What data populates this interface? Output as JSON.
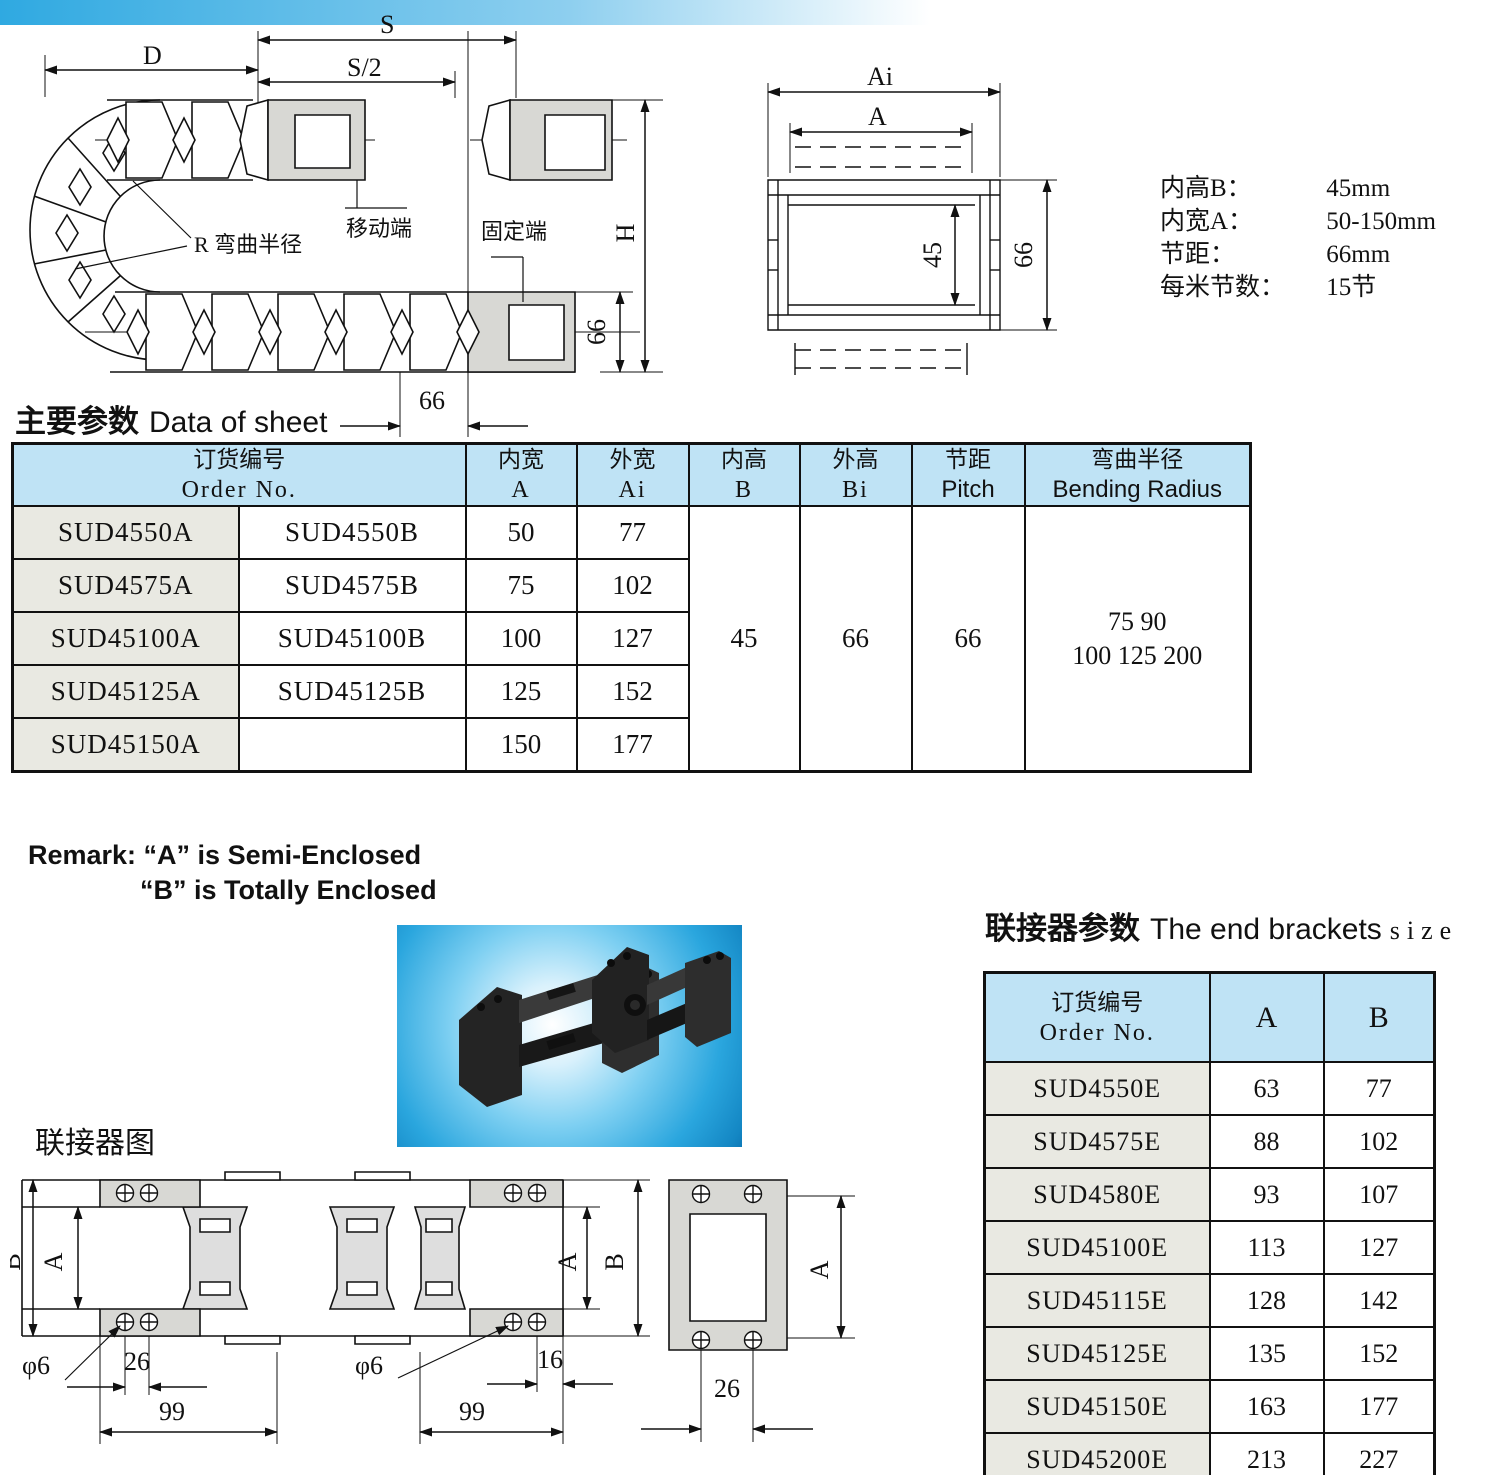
{
  "top_drawing": {
    "s": "S",
    "s_half": "S/2",
    "d": "D",
    "h": "H",
    "bend": "R 弯曲半径",
    "moving": "移动端",
    "fixed": "固定端",
    "pitch_66": "66",
    "height_66": "66"
  },
  "cross_section": {
    "ai": "Ai",
    "a": "A",
    "inner_h": "45",
    "outer_h": "66"
  },
  "specs": {
    "rows": [
      {
        "label": "内高B：",
        "value": "45mm"
      },
      {
        "label": "内宽A：",
        "value": "50-150mm"
      },
      {
        "label": "节距：",
        "value": "66mm"
      },
      {
        "label": "每米节数：",
        "value": "15节"
      }
    ]
  },
  "sheet": {
    "title_zh": "主要参数",
    "title_en": "Data of sheet",
    "header": {
      "order_zh": "订货编号",
      "order_en": "Order No.",
      "inner_w_zh": "内宽",
      "inner_w_en": "A",
      "outer_w_zh": "外宽",
      "outer_w_en": "Ai",
      "inner_h_zh": "内高",
      "inner_h_en": "B",
      "outer_h_zh": "外高",
      "outer_h_en": "Bi",
      "pitch_zh": "节距",
      "pitch_en": "Pitch",
      "bend_zh": "弯曲半径",
      "bend_en": "Bending Radius"
    },
    "rows": [
      {
        "a": "SUD4550A",
        "b": "SUD4550B",
        "inner_w": "50",
        "outer_w": "77"
      },
      {
        "a": "SUD4575A",
        "b": "SUD4575B",
        "inner_w": "75",
        "outer_w": "102"
      },
      {
        "a": "SUD45100A",
        "b": "SUD45100B",
        "inner_w": "100",
        "outer_w": "127"
      },
      {
        "a": "SUD45125A",
        "b": "SUD45125B",
        "inner_w": "125",
        "outer_w": "152"
      },
      {
        "a": "SUD45150A",
        "b": "",
        "inner_w": "150",
        "outer_w": "177"
      }
    ],
    "merged": {
      "inner_h": "45",
      "outer_h": "66",
      "pitch": "66",
      "bend_line1": "75 90",
      "bend_line2": "100 125 200"
    }
  },
  "remark": {
    "line1": "Remark: “A” is  Semi-Enclosed",
    "line2": "“B” is  Totally Enclosed"
  },
  "connector": {
    "diagram_title": "联接器图",
    "dims": {
      "b_left": "B",
      "a_left": "A",
      "dia_left": "φ6",
      "d26_left": "26",
      "d99_left": "99",
      "a_mid": "A",
      "b_mid": "B",
      "dia_mid": "φ6",
      "d16": "16",
      "d99_mid": "99",
      "a_front": "A",
      "d26_front": "26"
    }
  },
  "brackets": {
    "title_zh": "联接器参数",
    "title_en": "The end brackets",
    "title_size": "size",
    "header": {
      "order_zh": "订货编号",
      "order_en": "Order No.",
      "col_a": "A",
      "col_b": "B"
    },
    "rows": [
      [
        "SUD4550E",
        "63",
        "77"
      ],
      [
        "SUD4575E",
        "88",
        "102"
      ],
      [
        "SUD4580E",
        "93",
        "107"
      ],
      [
        "SUD45100E",
        "113",
        "127"
      ],
      [
        "SUD45115E",
        "128",
        "142"
      ],
      [
        "SUD45125E",
        "135",
        "152"
      ],
      [
        "SUD45150E",
        "163",
        "177"
      ],
      [
        "SUD45200E",
        "213",
        "227"
      ]
    ]
  }
}
